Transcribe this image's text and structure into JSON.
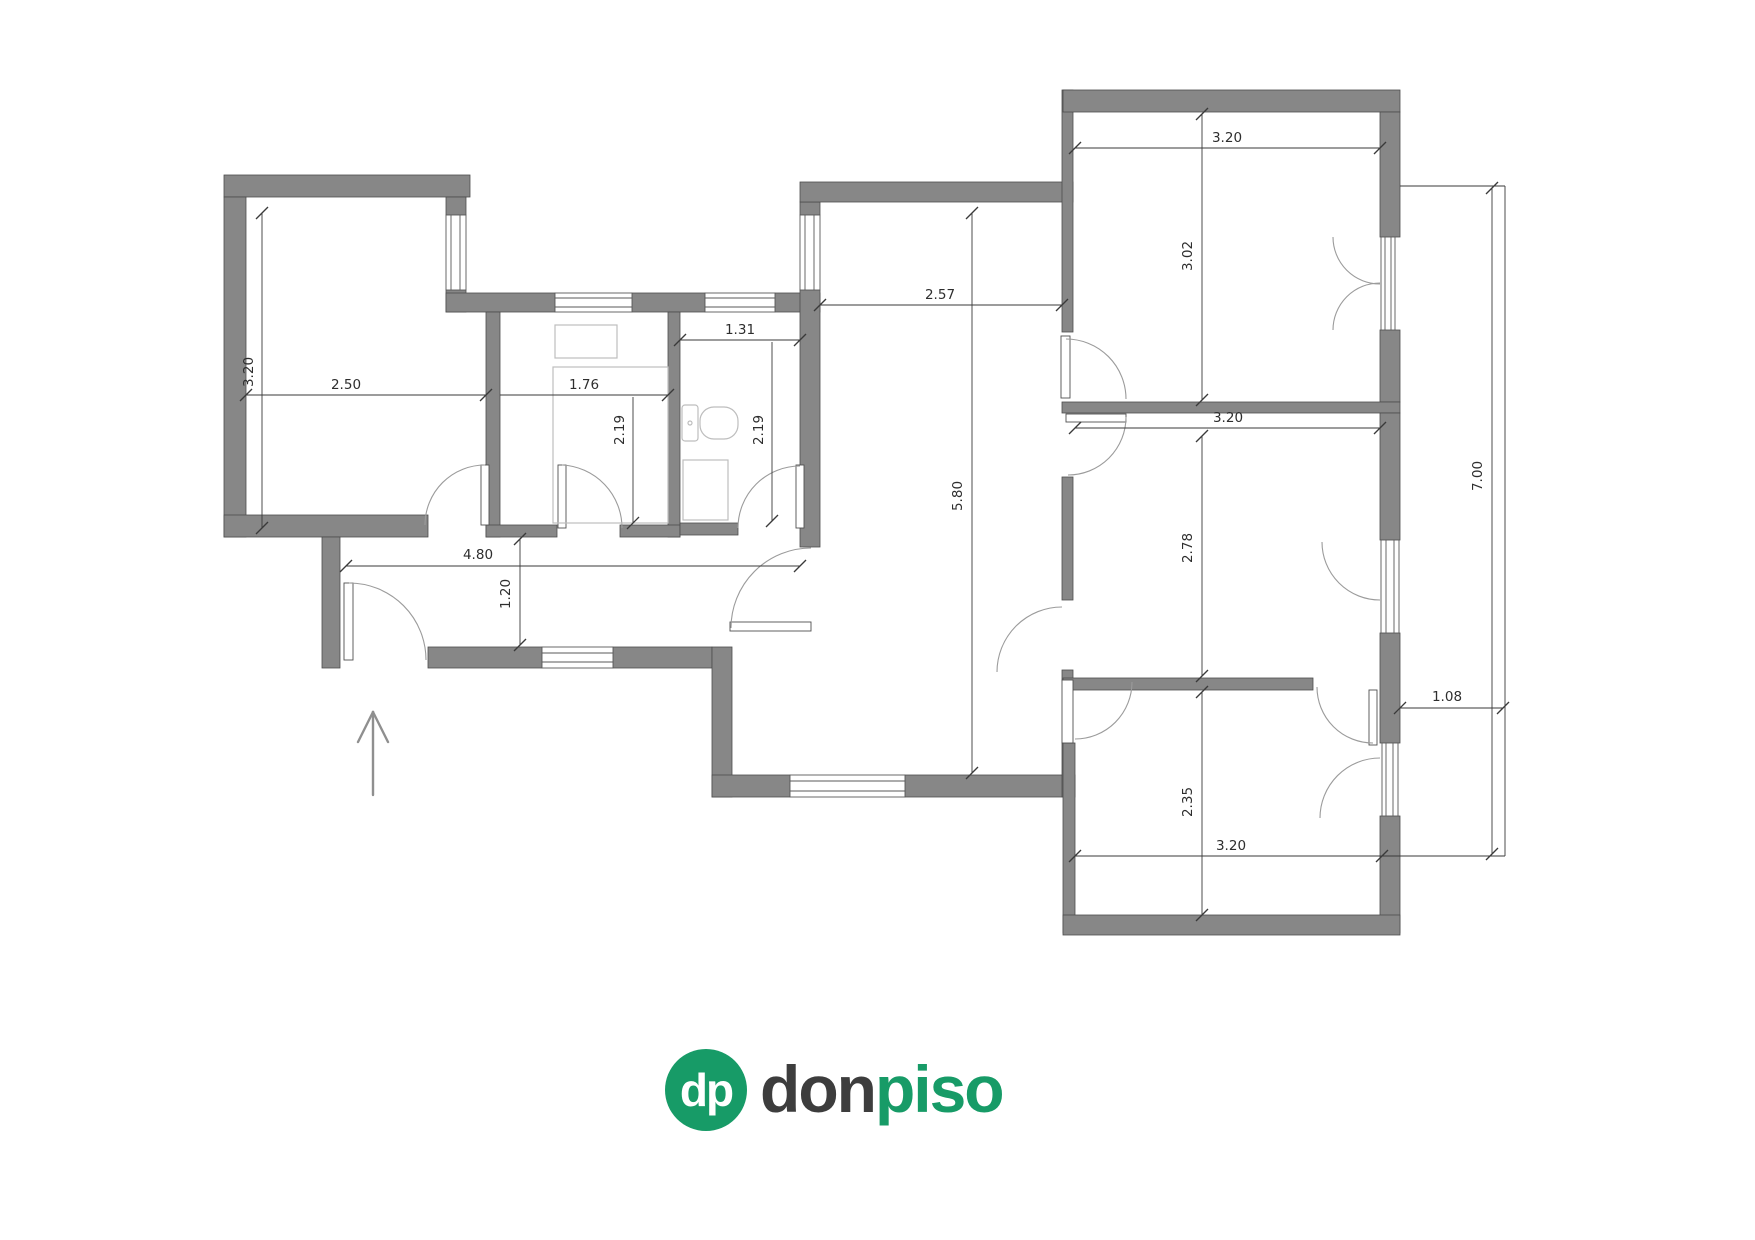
{
  "canvas": {
    "width": 1755,
    "height": 1240,
    "background": "#ffffff"
  },
  "colors": {
    "wall": "#878787",
    "wall-outline": "#4d4d4d",
    "dim-line": "#3a3a3a",
    "dim-text": "#2e2e2e",
    "door-arc": "#9b9b9b",
    "fixture": "#bdbdbd",
    "arrow": "#8f8f8f",
    "logo-green": "#179b67",
    "logo-dark": "#3d3d3d"
  },
  "dimensions": [
    {
      "id": "bedroom-left-height",
      "value": "3.20"
    },
    {
      "id": "bedroom-left-width",
      "value": "2.50"
    },
    {
      "id": "kitchen-width",
      "value": "1.76"
    },
    {
      "id": "kitchen-depth",
      "value": "2.19"
    },
    {
      "id": "bathroom-width",
      "value": "1.31"
    },
    {
      "id": "bathroom-depth",
      "value": "2.19"
    },
    {
      "id": "living-width",
      "value": "2.57"
    },
    {
      "id": "living-height",
      "value": "5.80"
    },
    {
      "id": "hall-length",
      "value": "4.80"
    },
    {
      "id": "hall-width",
      "value": "1.20"
    },
    {
      "id": "bedroom-topright-width",
      "value": "3.20"
    },
    {
      "id": "bedroom-topright-height",
      "value": "3.02"
    },
    {
      "id": "bedroom-midright-width",
      "value": "3.20"
    },
    {
      "id": "bedroom-midright-height",
      "value": "2.78"
    },
    {
      "id": "bedroom-bottomright-width",
      "value": "3.20"
    },
    {
      "id": "bedroom-bottomright-height",
      "value": "2.35"
    },
    {
      "id": "balcony-width",
      "value": "1.08"
    },
    {
      "id": "balcony-length",
      "value": "7.00"
    }
  ],
  "logo": {
    "monogram": "dp",
    "word_dark": "don",
    "word_green": "piso"
  }
}
